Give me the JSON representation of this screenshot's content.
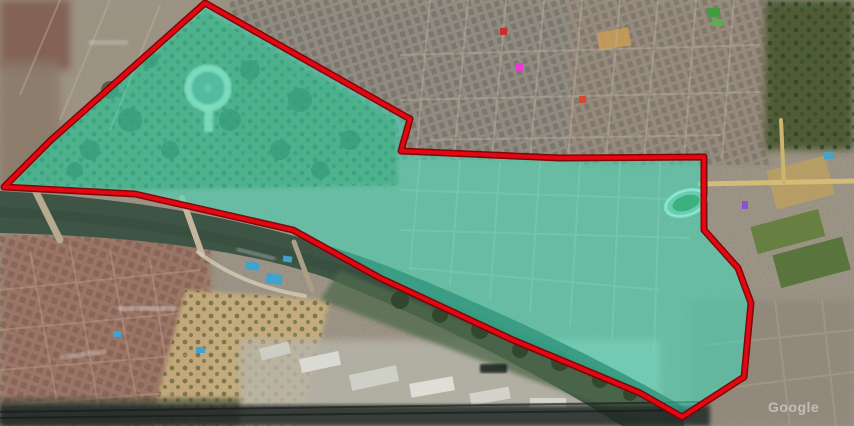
{
  "map": {
    "watermark": {
      "text": "Google"
    },
    "region_overlay": {
      "fill": "#35E6C2",
      "fill_opacity": "0.5",
      "stroke": "#E30613",
      "stroke_outer": "#7E0000",
      "points": "205,3 410,119 401,151 560,158 704,157 704,230 738,268 751,303 744,377 682,417 640,393 513,340 380,278 293,230 135,194 4,187 41,150 50,141"
    },
    "markers": [
      {
        "id": "marker-magenta",
        "x": 516,
        "y": 63,
        "width": 7,
        "height": 8,
        "color": "#E93BD4"
      },
      {
        "id": "marker-red-north",
        "x": 500,
        "y": 28,
        "width": 7,
        "height": 7,
        "color": "#C62F23"
      },
      {
        "id": "marker-red-east",
        "x": 579,
        "y": 96,
        "width": 7,
        "height": 7,
        "color": "#DE4530"
      },
      {
        "id": "marker-purple",
        "x": 742,
        "y": 201,
        "width": 6,
        "height": 8,
        "color": "#8F4FD1"
      }
    ],
    "features": [
      "river",
      "bridges",
      "circular-plaza",
      "stadium",
      "swimming-pools",
      "sports-fields",
      "highlighted-district-polygon",
      "google-watermark"
    ]
  }
}
